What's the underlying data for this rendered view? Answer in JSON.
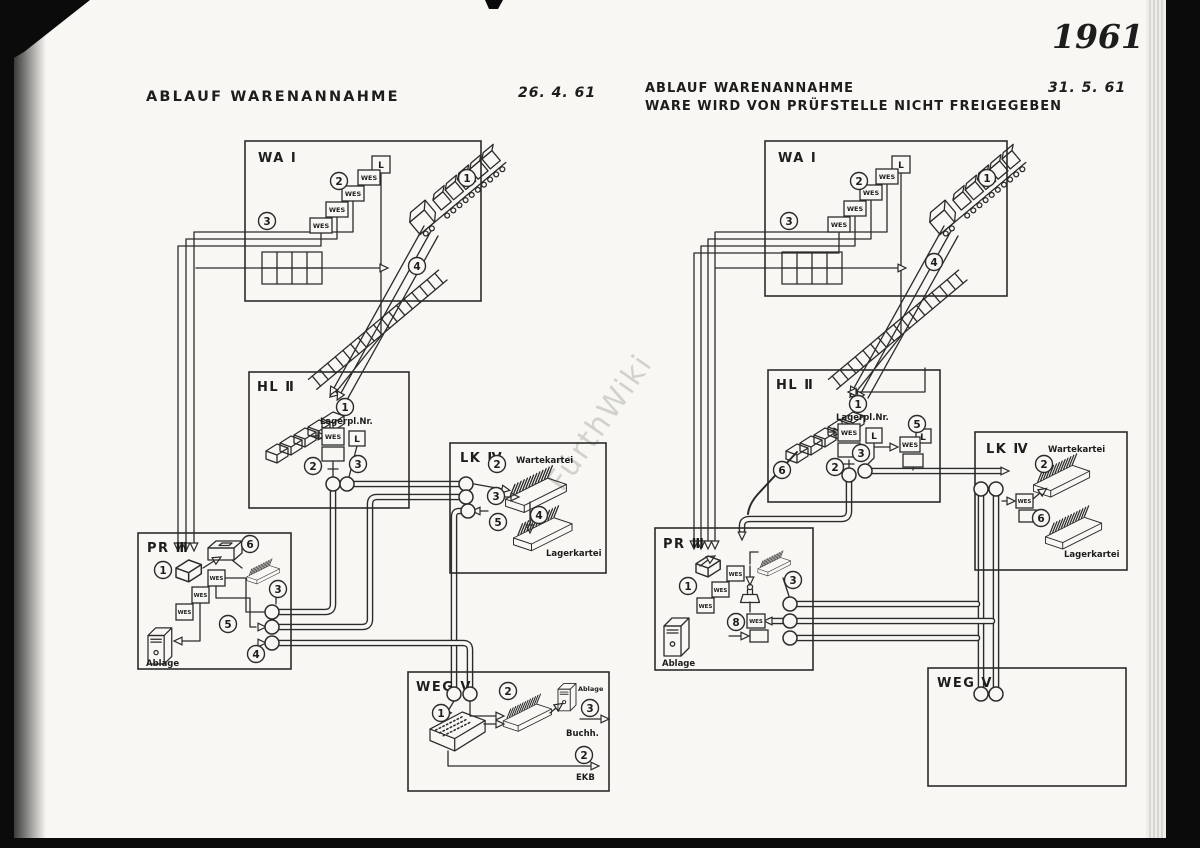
{
  "page": {
    "year": "1961",
    "watermark": "FürthWiki"
  },
  "left": {
    "title": "ABLAUF WARENANNAHME",
    "date": "26. 4. 61",
    "wa": {
      "name": "WA Ⅰ",
      "l": "L",
      "wes": [
        "WES",
        "WES",
        "WES",
        "WES"
      ],
      "steps": [
        "1",
        "2",
        "3",
        "4"
      ]
    },
    "hl": {
      "name": "HL Ⅱ",
      "lagerplatz": "Lagerpl.Nr.",
      "wes": "WES",
      "l": "L",
      "steps": [
        "1",
        "2",
        "3"
      ]
    },
    "lk": {
      "name": "LK Ⅳ",
      "wartekartei": "Wartekartei",
      "lagerkartei": "Lagerkartei",
      "steps": [
        "2",
        "3",
        "4",
        "5"
      ]
    },
    "pr": {
      "name": "PR Ⅲ",
      "wes": [
        "WES",
        "WES",
        "WES"
      ],
      "ablage": "Ablage",
      "steps": [
        "1",
        "6",
        "3",
        "5",
        "4"
      ]
    },
    "weg": {
      "name": "WEG Ⅴ",
      "ablage": "Ablage",
      "buchh": "Buchh.",
      "ekb": "EKB",
      "steps": [
        "1",
        "2",
        "3",
        "2"
      ]
    }
  },
  "right": {
    "title": "ABLAUF WARENANNAHME",
    "subtitle": "WARE WIRD VON PRÜFSTELLE NICHT FREIGEGEBEN",
    "date": "31. 5. 61",
    "wa": {
      "name": "WA Ⅰ",
      "l": "L",
      "wes": [
        "WES",
        "WES",
        "WES",
        "WES"
      ],
      "steps": [
        "1",
        "2",
        "3",
        "4"
      ]
    },
    "hl": {
      "name": "HL Ⅱ",
      "lagerplatz": "Lagerpl.Nr.",
      "wes": [
        "WES",
        "WES"
      ],
      "l": [
        "L",
        "L"
      ],
      "steps": [
        "1",
        "2",
        "3",
        "5",
        "6"
      ]
    },
    "lk": {
      "name": "LK Ⅳ",
      "wes": "WES",
      "wartekartei": "Wartekartei",
      "lagerkartei": "Lagerkartei",
      "steps": [
        "2",
        "6"
      ]
    },
    "pr": {
      "name": "PR Ⅲ",
      "wes": [
        "WES",
        "WES",
        "WES",
        "WES"
      ],
      "ablage": "Ablage",
      "steps": [
        "1",
        "3",
        "8"
      ]
    },
    "weg": {
      "name": "WEG Ⅴ"
    }
  }
}
